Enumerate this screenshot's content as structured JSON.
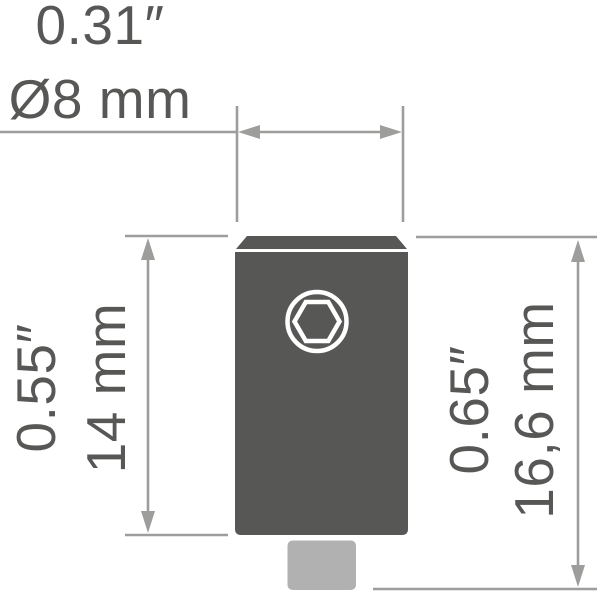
{
  "drawing": {
    "description": "Technical dimension drawing of a hex-socket adapter with chamfered top and shaft stub",
    "dimensions": {
      "top": {
        "inches": "0.31″",
        "metric": "Ø8 mm"
      },
      "left": {
        "inches": "0.55″",
        "metric": "14 mm"
      },
      "right": {
        "inches": "0.65″",
        "metric": "16,6 mm"
      }
    },
    "colors": {
      "background": "#ffffff",
      "body": "#575756",
      "shaft": "#b1b1b1",
      "line": "#9d9d9c",
      "text": "#575756",
      "socket_outline": "#ffffff"
    }
  }
}
